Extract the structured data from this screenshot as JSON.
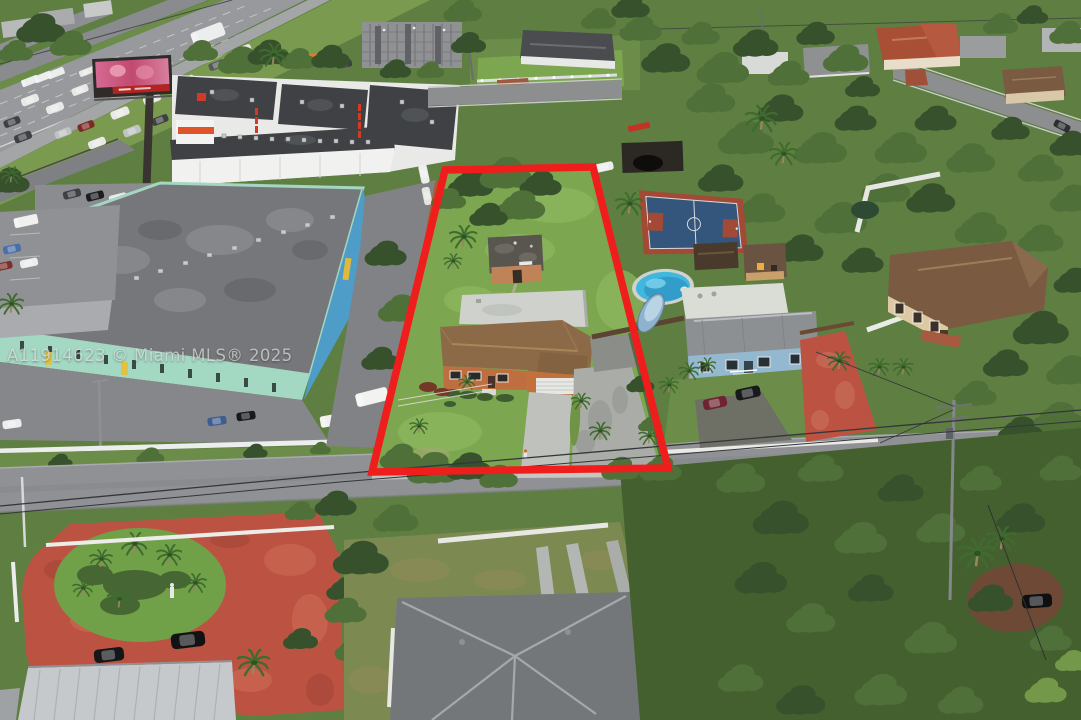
{
  "watermark": {
    "text": "A11914623 © Miami MLS® 2025",
    "color": "#ffffff",
    "opacity": 0.62
  },
  "property_outline": {
    "color": "#f01d1d",
    "stroke_width": 7.5
  },
  "palette": {
    "base-green": "#5f7f42",
    "tree-dark": "#36512c",
    "tree-mid": "#4f7038",
    "tree-light": "#74984a",
    "grass": "#7ca64f",
    "grass-dark": "#6c8d49",
    "lawn-highlight": "#8fb95f",
    "asphalt": "#97999c",
    "asphalt-dark": "#7e8083",
    "concrete": "#bfc2bc",
    "roof-dark": "#3f4144",
    "white-wall": "#e9eae8",
    "teal-wall": "#a3d8c3",
    "warehouse-roof": "#75777a",
    "blue-accent": "#4e9cc8",
    "orange-accent": "#e0542a",
    "red-outline": "#f01d1d",
    "house-roof": "#8c6a48",
    "house-wall": "#bf6f3f",
    "pool-blue": "#41b6df",
    "court-blue": "#35567c",
    "court-red": "#a34a37",
    "red-pavement": "#bc5342",
    "blue-house-wall": "#93b8cf",
    "gray-roof": "#74777a",
    "metal-roof": "#c6c9cb",
    "beige-wall": "#ddcaa5",
    "brown-roof": "#7a5b41",
    "red-tile-roof": "#a84f36",
    "road": "#8f9194"
  }
}
